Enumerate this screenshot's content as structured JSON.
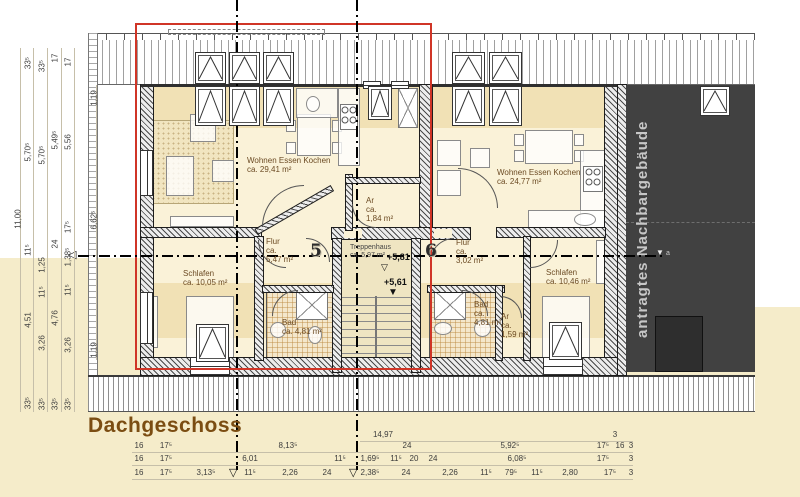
{
  "title": "Dachgeschoss",
  "neighbor": {
    "label": "antragtes Nachbargebäude",
    "level_marker": "▼",
    "level_marker_suffix": "a"
  },
  "section_marks": {
    "arrow_left": "◁",
    "arrow_down_1": "▽",
    "arrow_down_2": "▽"
  },
  "apartments": {
    "left": {
      "number": "5",
      "wohnen": "Wohnen Essen Kochen\nca. 29,41 m²",
      "flur": "Flur\nca.\n5,47 m²",
      "schlafen": "Schlafen\nca. 10,05 m²",
      "bad": "Bad\nca. 4,81 m²",
      "ar": "Ar\nca.\n1,84 m²"
    },
    "right": {
      "number": "6",
      "wohnen": "Wohnen Essen Kochen\nca. 24,77 m²",
      "flur": "Flur\nca.\n3,02 m²",
      "schlafen": "Schlafen\nca. 10,46 m²",
      "bad": "Bad\nca.\n4,81 m²",
      "ar": "Ar\nca.\n1,59 m²"
    }
  },
  "stairwell": {
    "label": "Treppenhaus\nca. 5,97 m²",
    "level_upper": "+5,81",
    "level_upper_mark": "▽",
    "level_lower": "+5,61",
    "level_lower_mark": "▼"
  },
  "colors": {
    "accent_red": "#d03527",
    "background_cream": "#f5ecca",
    "room_band_tan": "#f1e1b5",
    "neighbor_fill": "#414141",
    "title_brown": "#7b4d12"
  },
  "dimensions": {
    "left": [
      {
        "t": "11,00",
        "x": 18,
        "y": 219
      },
      {
        "t": "33⁵",
        "x": 28,
        "y": 63
      },
      {
        "t": "5,70⁵",
        "x": 28,
        "y": 152
      },
      {
        "t": "11⁵",
        "x": 28,
        "y": 250
      },
      {
        "t": "4,51",
        "x": 28,
        "y": 320
      },
      {
        "t": "33⁵",
        "x": 28,
        "y": 403
      },
      {
        "t": "33⁵",
        "x": 42,
        "y": 66
      },
      {
        "t": "5,70⁵",
        "x": 42,
        "y": 155
      },
      {
        "t": "1,25",
        "x": 42,
        "y": 265
      },
      {
        "t": "11⁵",
        "x": 42,
        "y": 292
      },
      {
        "t": "3,26",
        "x": 42,
        "y": 343
      },
      {
        "t": "33⁵",
        "x": 42,
        "y": 404
      },
      {
        "t": "17",
        "x": 55,
        "y": 58
      },
      {
        "t": "5,49⁵",
        "x": 55,
        "y": 140
      },
      {
        "t": "24",
        "x": 55,
        "y": 244
      },
      {
        "t": "4,76",
        "x": 55,
        "y": 318
      },
      {
        "t": "33⁵",
        "x": 55,
        "y": 404
      },
      {
        "t": "17",
        "x": 68,
        "y": 62
      },
      {
        "t": "5,56",
        "x": 68,
        "y": 142
      },
      {
        "t": "17⁵",
        "x": 68,
        "y": 227
      },
      {
        "t": "1,38⁵",
        "x": 68,
        "y": 257
      },
      {
        "t": "11⁵",
        "x": 68,
        "y": 290
      },
      {
        "t": "3,26",
        "x": 68,
        "y": 345
      },
      {
        "t": "33⁵",
        "x": 68,
        "y": 404
      },
      {
        "t": "1,19",
        "x": 94,
        "y": 98
      },
      {
        "t": "6,62⁵",
        "x": 94,
        "y": 220
      },
      {
        "t": "1,19",
        "x": 94,
        "y": 350
      }
    ],
    "bottom": [
      {
        "t": "14,97",
        "x": 383,
        "y": 439
      },
      {
        "t": "3",
        "x": 615,
        "y": 439
      },
      {
        "t": "16",
        "x": 139,
        "y": 450
      },
      {
        "t": "17⁵",
        "x": 166,
        "y": 450
      },
      {
        "t": "8,13⁵",
        "x": 288,
        "y": 450
      },
      {
        "t": "24",
        "x": 407,
        "y": 450
      },
      {
        "t": "5,92⁵",
        "x": 510,
        "y": 450
      },
      {
        "t": "17⁵",
        "x": 603,
        "y": 450
      },
      {
        "t": "16",
        "x": 620,
        "y": 450
      },
      {
        "t": "3",
        "x": 631,
        "y": 450
      },
      {
        "t": "16",
        "x": 139,
        "y": 463
      },
      {
        "t": "17⁵",
        "x": 166,
        "y": 463
      },
      {
        "t": "6,01",
        "x": 250,
        "y": 463
      },
      {
        "t": "11⁵",
        "x": 340,
        "y": 463
      },
      {
        "t": "1,69⁵",
        "x": 370,
        "y": 463
      },
      {
        "t": "11⁵",
        "x": 396,
        "y": 463
      },
      {
        "t": "20",
        "x": 414,
        "y": 463
      },
      {
        "t": "24",
        "x": 433,
        "y": 463
      },
      {
        "t": "6,08⁵",
        "x": 517,
        "y": 463
      },
      {
        "t": "17⁵",
        "x": 603,
        "y": 463
      },
      {
        "t": "3",
        "x": 631,
        "y": 463
      },
      {
        "t": "16",
        "x": 139,
        "y": 477
      },
      {
        "t": "17⁵",
        "x": 166,
        "y": 477
      },
      {
        "t": "3,13⁵",
        "x": 206,
        "y": 477
      },
      {
        "t": "11⁵",
        "x": 250,
        "y": 477
      },
      {
        "t": "2,26",
        "x": 290,
        "y": 477
      },
      {
        "t": "24",
        "x": 327,
        "y": 477
      },
      {
        "t": "2,38⁵",
        "x": 370,
        "y": 477
      },
      {
        "t": "24",
        "x": 406,
        "y": 477
      },
      {
        "t": "2,26",
        "x": 450,
        "y": 477
      },
      {
        "t": "11⁵",
        "x": 486,
        "y": 477
      },
      {
        "t": "79⁵",
        "x": 511,
        "y": 477
      },
      {
        "t": "11⁵",
        "x": 537,
        "y": 477
      },
      {
        "t": "2,80",
        "x": 570,
        "y": 477
      },
      {
        "t": "17⁵",
        "x": 610,
        "y": 477
      },
      {
        "t": "3",
        "x": 631,
        "y": 477
      }
    ]
  }
}
